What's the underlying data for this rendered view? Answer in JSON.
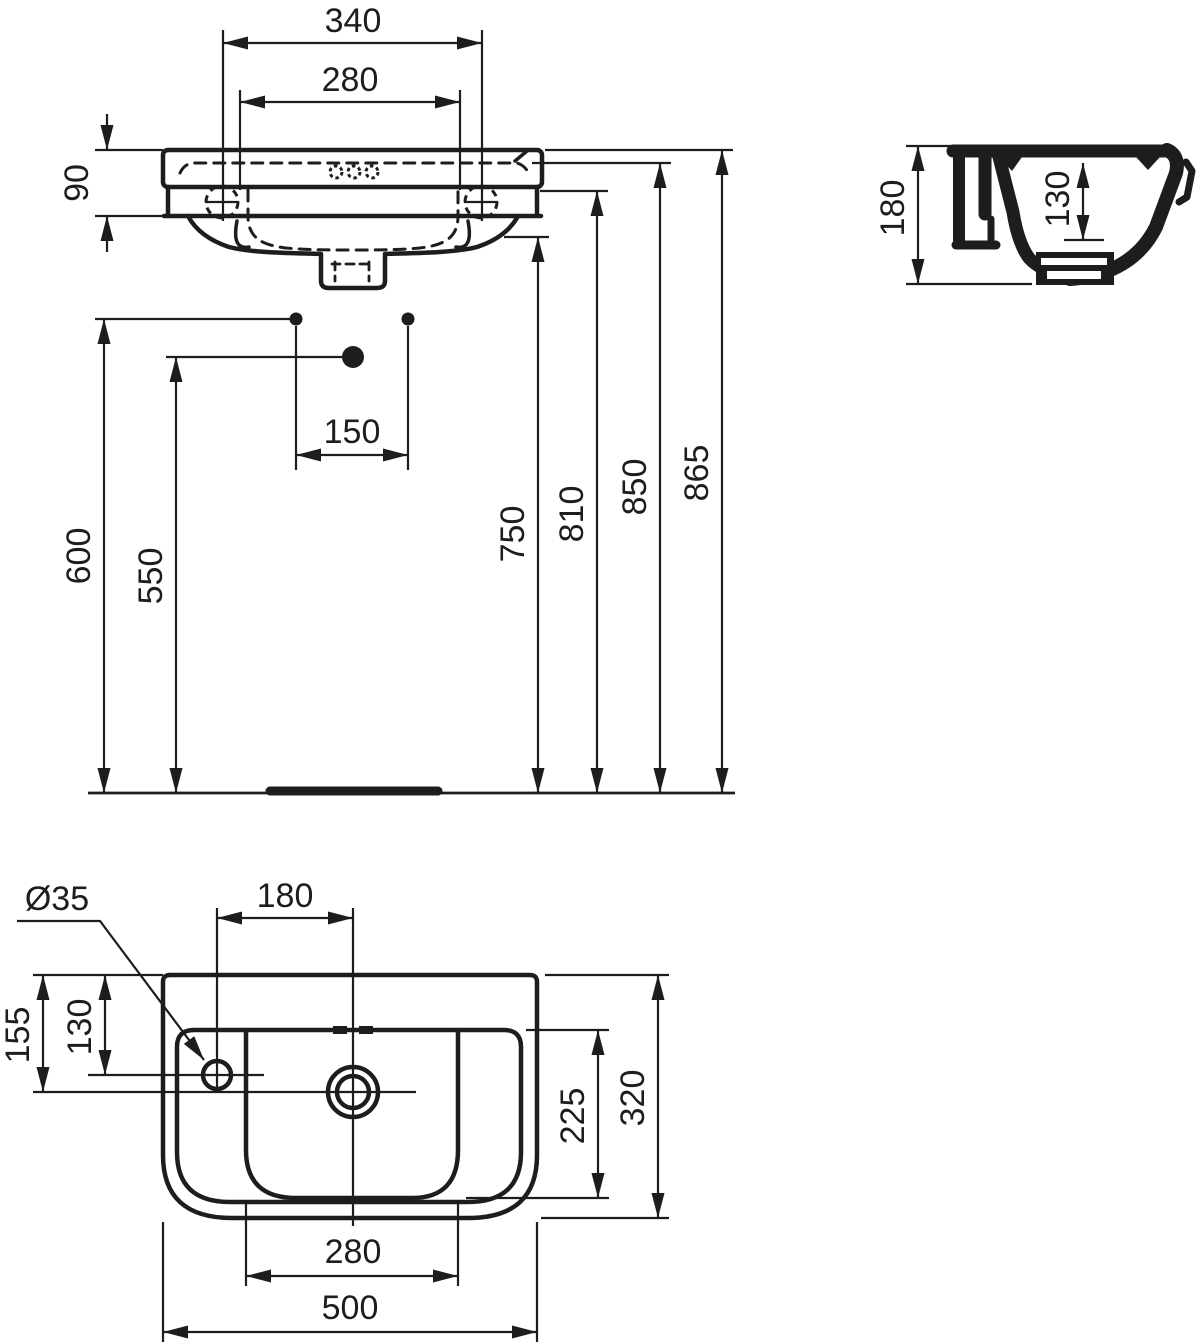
{
  "drawing_type": "washbasin-dimensional-drawing",
  "colors": {
    "line": "#1d1d1b",
    "background": "#ffffff"
  },
  "views": {
    "front": {
      "dims": {
        "overall_width": "340",
        "inner_width": "280",
        "rim_height": "90",
        "fixing_hole_spacing": "150",
        "fixing_hole_height": "600",
        "outlet_height": "550",
        "underside_height": "750",
        "apron_height": "810",
        "inner_rim_height": "850",
        "rim_top_height": "865"
      }
    },
    "side": {
      "dims": {
        "overall_height": "180",
        "bowl_depth": "130"
      }
    },
    "plan": {
      "dims": {
        "tap_hole_diameter": "Ø35",
        "tap_to_drain": "180",
        "edge_to_drain": "155",
        "edge_to_tap": "130",
        "bowl_width": "225",
        "overall_depth": "320",
        "bowl_length": "280",
        "overall_width": "500"
      }
    }
  }
}
